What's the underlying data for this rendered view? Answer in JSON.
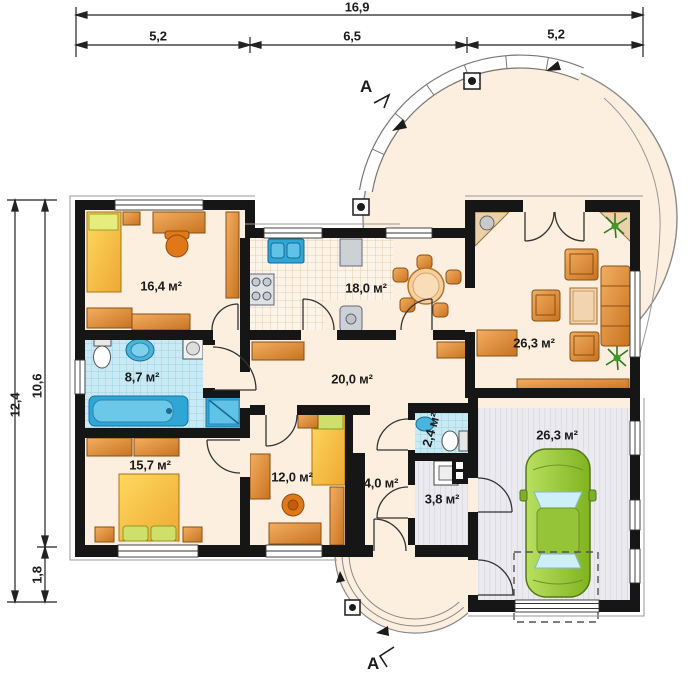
{
  "plan": {
    "section_marker": "A",
    "dimensions": {
      "top_total": "16,9",
      "top_segments": [
        "5,2",
        "6,5",
        "5,2"
      ],
      "side_total": "12,4",
      "side_upper": "10,6",
      "side_lower": "1,8"
    },
    "rooms": [
      {
        "id": "bedroom-1",
        "area": "16,4 м²"
      },
      {
        "id": "kitchen-dining",
        "area": "18,0 м²"
      },
      {
        "id": "living-room",
        "area": "26,3 м²"
      },
      {
        "id": "bathroom",
        "area": "8,7 м²"
      },
      {
        "id": "hall",
        "area": "20,0 м²"
      },
      {
        "id": "bedroom-2",
        "area": "15,7 м²"
      },
      {
        "id": "bedroom-3",
        "area": "12,0 м²"
      },
      {
        "id": "wc",
        "area": "2,4 м²"
      },
      {
        "id": "vestibule",
        "area": "4,0 м²"
      },
      {
        "id": "boiler-room",
        "area": "3,8 м²"
      },
      {
        "id": "garage",
        "area": "26,3 м²"
      }
    ],
    "colors": {
      "wall": "#161616",
      "floor": "#fcefdf",
      "furniture_wood": "#d98a3c",
      "bed_yellow": "#f8c53e",
      "tile_blue": "#c9eaf5",
      "fixture_blue": "#2ea6d6",
      "car_green": "#9ac937",
      "garage_floor": "#eaeaef"
    }
  }
}
